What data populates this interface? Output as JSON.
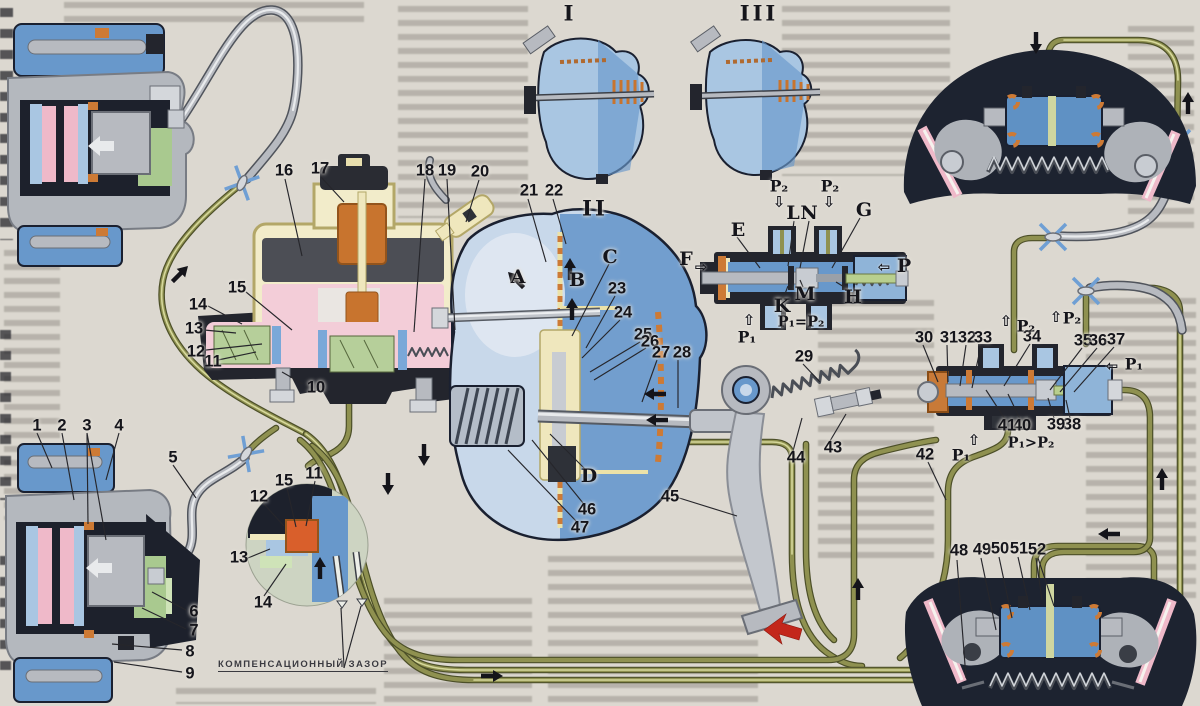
{
  "figure": {
    "caption_inset": "КОМПЕНСАЦИОННЫЙ ЗАЗОР"
  },
  "callouts": [
    {
      "id": "sec1",
      "text": "I"
    },
    {
      "id": "sec2",
      "text": "II"
    },
    {
      "id": "sec3",
      "text": "III"
    },
    {
      "id": "n1",
      "text": "1"
    },
    {
      "id": "n2",
      "text": "2"
    },
    {
      "id": "n3",
      "text": "3"
    },
    {
      "id": "n4",
      "text": "4"
    },
    {
      "id": "n5",
      "text": "5"
    },
    {
      "id": "n6",
      "text": "6"
    },
    {
      "id": "n7",
      "text": "7"
    },
    {
      "id": "n8",
      "text": "8"
    },
    {
      "id": "n9",
      "text": "9"
    },
    {
      "id": "n10",
      "text": "10"
    },
    {
      "id": "n11",
      "text": "11"
    },
    {
      "id": "n12",
      "text": "12"
    },
    {
      "id": "n13",
      "text": "13"
    },
    {
      "id": "n14",
      "text": "14"
    },
    {
      "id": "n15",
      "text": "15"
    },
    {
      "id": "n16",
      "text": "16"
    },
    {
      "id": "n17",
      "text": "17"
    },
    {
      "id": "n18",
      "text": "18"
    },
    {
      "id": "n19",
      "text": "19"
    },
    {
      "id": "n20",
      "text": "20"
    },
    {
      "id": "n21",
      "text": "21"
    },
    {
      "id": "n22",
      "text": "22"
    },
    {
      "id": "n23",
      "text": "23"
    },
    {
      "id": "n24",
      "text": "24"
    },
    {
      "id": "n25",
      "text": "25"
    },
    {
      "id": "n26",
      "text": "26"
    },
    {
      "id": "n27",
      "text": "27"
    },
    {
      "id": "n28",
      "text": "28"
    },
    {
      "id": "n29",
      "text": "29"
    },
    {
      "id": "n30",
      "text": "30"
    },
    {
      "id": "n31",
      "text": "31"
    },
    {
      "id": "n32",
      "text": "32"
    },
    {
      "id": "n33",
      "text": "33"
    },
    {
      "id": "n34",
      "text": "34"
    },
    {
      "id": "n35",
      "text": "35"
    },
    {
      "id": "n36",
      "text": "36"
    },
    {
      "id": "n37",
      "text": "37"
    },
    {
      "id": "n38",
      "text": "38"
    },
    {
      "id": "n39",
      "text": "39"
    },
    {
      "id": "n40",
      "text": "40"
    },
    {
      "id": "n41",
      "text": "41"
    },
    {
      "id": "n42",
      "text": "42"
    },
    {
      "id": "n43",
      "text": "43"
    },
    {
      "id": "n44",
      "text": "44"
    },
    {
      "id": "n45",
      "text": "45"
    },
    {
      "id": "n46",
      "text": "46"
    },
    {
      "id": "n47",
      "text": "47"
    },
    {
      "id": "n48",
      "text": "48"
    },
    {
      "id": "n49",
      "text": "49"
    },
    {
      "id": "n50",
      "text": "50"
    },
    {
      "id": "n51",
      "text": "51"
    },
    {
      "id": "n52",
      "text": "52"
    },
    {
      "id": "i11",
      "text": "11"
    },
    {
      "id": "i12",
      "text": "12"
    },
    {
      "id": "i13",
      "text": "13"
    },
    {
      "id": "i14",
      "text": "14"
    },
    {
      "id": "i15",
      "text": "15"
    },
    {
      "id": "lA",
      "text": "A"
    },
    {
      "id": "lB",
      "text": "B"
    },
    {
      "id": "lC",
      "text": "C"
    },
    {
      "id": "lD",
      "text": "D"
    },
    {
      "id": "lE",
      "text": "E"
    },
    {
      "id": "lF",
      "text": "F"
    },
    {
      "id": "lG",
      "text": "G"
    },
    {
      "id": "lH",
      "text": "H"
    },
    {
      "id": "lK",
      "text": "K"
    },
    {
      "id": "lL",
      "text": "L"
    },
    {
      "id": "lM",
      "text": "M"
    },
    {
      "id": "lN",
      "text": "N"
    },
    {
      "id": "lP",
      "text": "P"
    },
    {
      "id": "p2a",
      "text": "P₂"
    },
    {
      "id": "p2b",
      "text": "P₂"
    },
    {
      "id": "p1a",
      "text": "P₁"
    },
    {
      "id": "peq",
      "text": "P₁=P₂"
    },
    {
      "id": "p2c",
      "text": "P₂"
    },
    {
      "id": "p2d",
      "text": "P₂"
    },
    {
      "id": "p1b",
      "text": "P₁"
    },
    {
      "id": "p1c",
      "text": "P₁"
    },
    {
      "id": "pgt",
      "text": "P₁>P₂"
    }
  ],
  "icons": {
    "hollow_arrow_up": "⇧",
    "hollow_arrow_down": "⇩",
    "hollow_arrow_left": "⇦",
    "hollow_arrow_right": "⇨"
  },
  "colors": {
    "paper": "#dcd8d0",
    "pipe_olive": "#8f9150",
    "hydraulic_blue": "#6898cb",
    "pad_pink": "#efb9c9",
    "seal_orange": "#cd7a35",
    "pedal_arrow_red": "#c3271b"
  }
}
